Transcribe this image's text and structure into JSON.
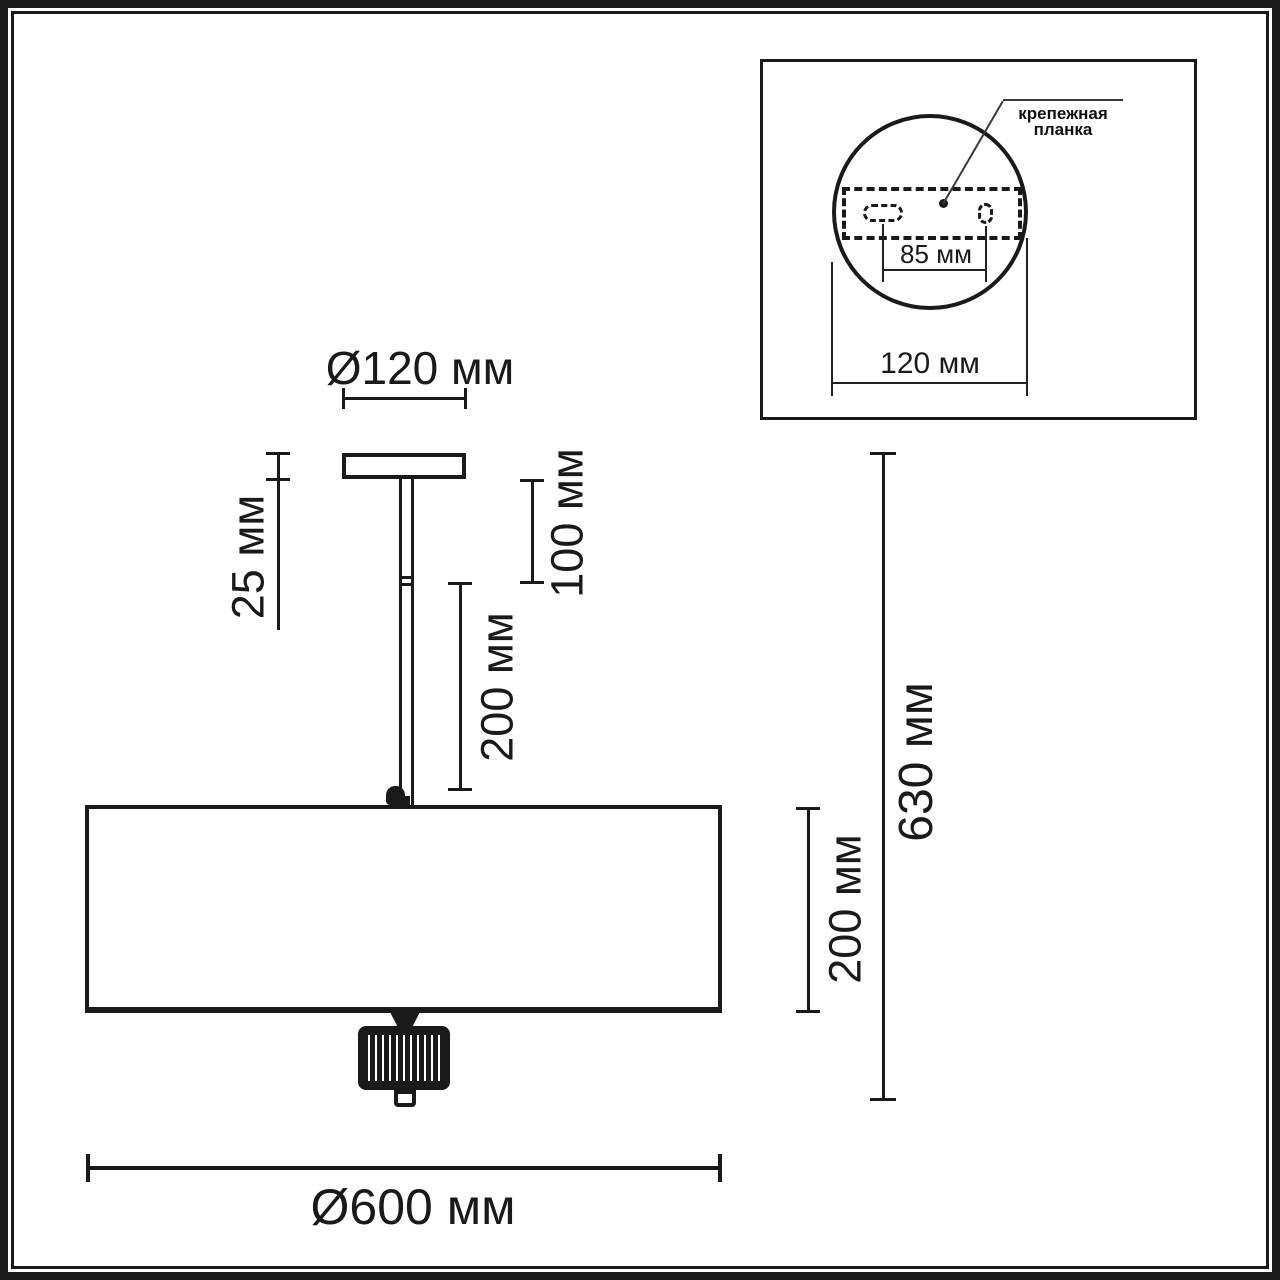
{
  "colors": {
    "line": "#1a1a1a",
    "thin_line": "#3a3a3a",
    "background": "#ffffff"
  },
  "main_view": {
    "canopy_diameter_label": "Ø120 мм",
    "canopy_height_label": "25 мм",
    "rod_upper_segment_label": "100 мм",
    "rod_lower_segment_label": "200 мм",
    "shade_height_label": "200 мм",
    "total_height_label": "630 мм",
    "shade_diameter_label": "Ø600 мм"
  },
  "inset_view": {
    "mounting_plate_label_line1": "крепежная",
    "mounting_plate_label_line2": "планка",
    "hole_spacing_label": "85 мм",
    "base_diameter_label": "120 мм"
  }
}
